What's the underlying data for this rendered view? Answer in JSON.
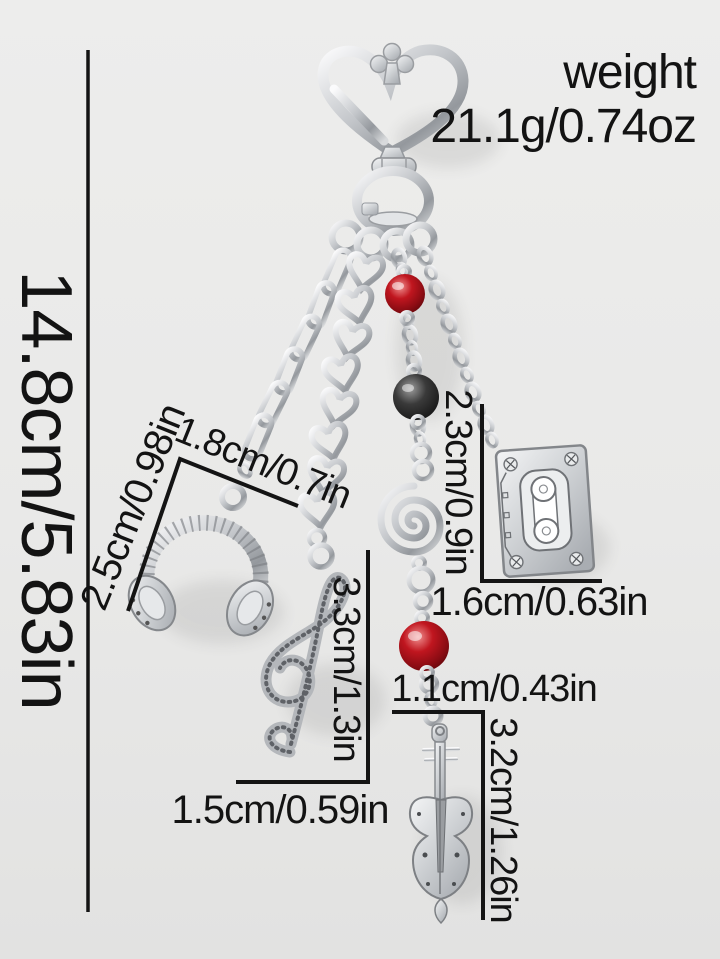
{
  "weight": {
    "label": "weight",
    "value": "21.1g/0.74oz"
  },
  "dimensions": {
    "overall_height": "14.8cm/5.83in",
    "headphones_height": "2.5cm/0.98in",
    "headphones_width": "1.8cm/0.7in",
    "cassette_height": "2.3cm/0.9in",
    "cassette_width": "1.6cm/0.63in",
    "treble_clef_height": "3.3cm/1.3in",
    "treble_clef_width": "1.5cm/0.59in",
    "violin_width": "1.1cm/0.43in",
    "violin_height": "3.2cm/1.26in"
  },
  "charms": {
    "clasp": "heart-carabiner",
    "items": [
      "headphones",
      "treble-clef",
      "spiral",
      "cassette-tape",
      "violin"
    ],
    "beads": [
      "red",
      "black",
      "red"
    ]
  },
  "colors": {
    "background": "#e9e9e8",
    "annotation": "#131313",
    "silver": "#c6c9cd",
    "bead_red": "#8e0d15",
    "bead_black": "#1a1a1a"
  }
}
